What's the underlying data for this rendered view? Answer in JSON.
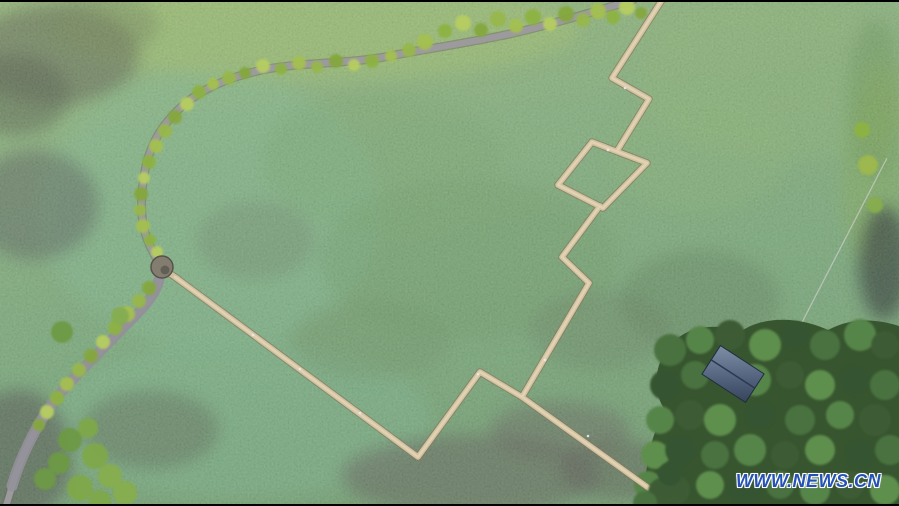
{
  "watermark": {
    "text": "WWW.NEWS.CN",
    "color": "#2453b5",
    "outline_color": "#ffffff"
  },
  "colors": {
    "letterbox_bar": "#000000",
    "field_base": "#7ba578",
    "field_teal_patch": "#7cb392",
    "boardwalk": "#d2c2a1",
    "boardwalk_edge": "#86755a",
    "dirt_road": "#9c9a9d",
    "dirt_road_edge": "#6e6c66",
    "roadside_trees": "#a4c050",
    "tree_grove": "#37552f",
    "grove_canopy": "#4a7240",
    "hut_roof_light": "#7d8ea6",
    "hut_roof_dark": "#36435b",
    "pavilion_roof": "#837d70",
    "dark_water": "#4a4249"
  }
}
